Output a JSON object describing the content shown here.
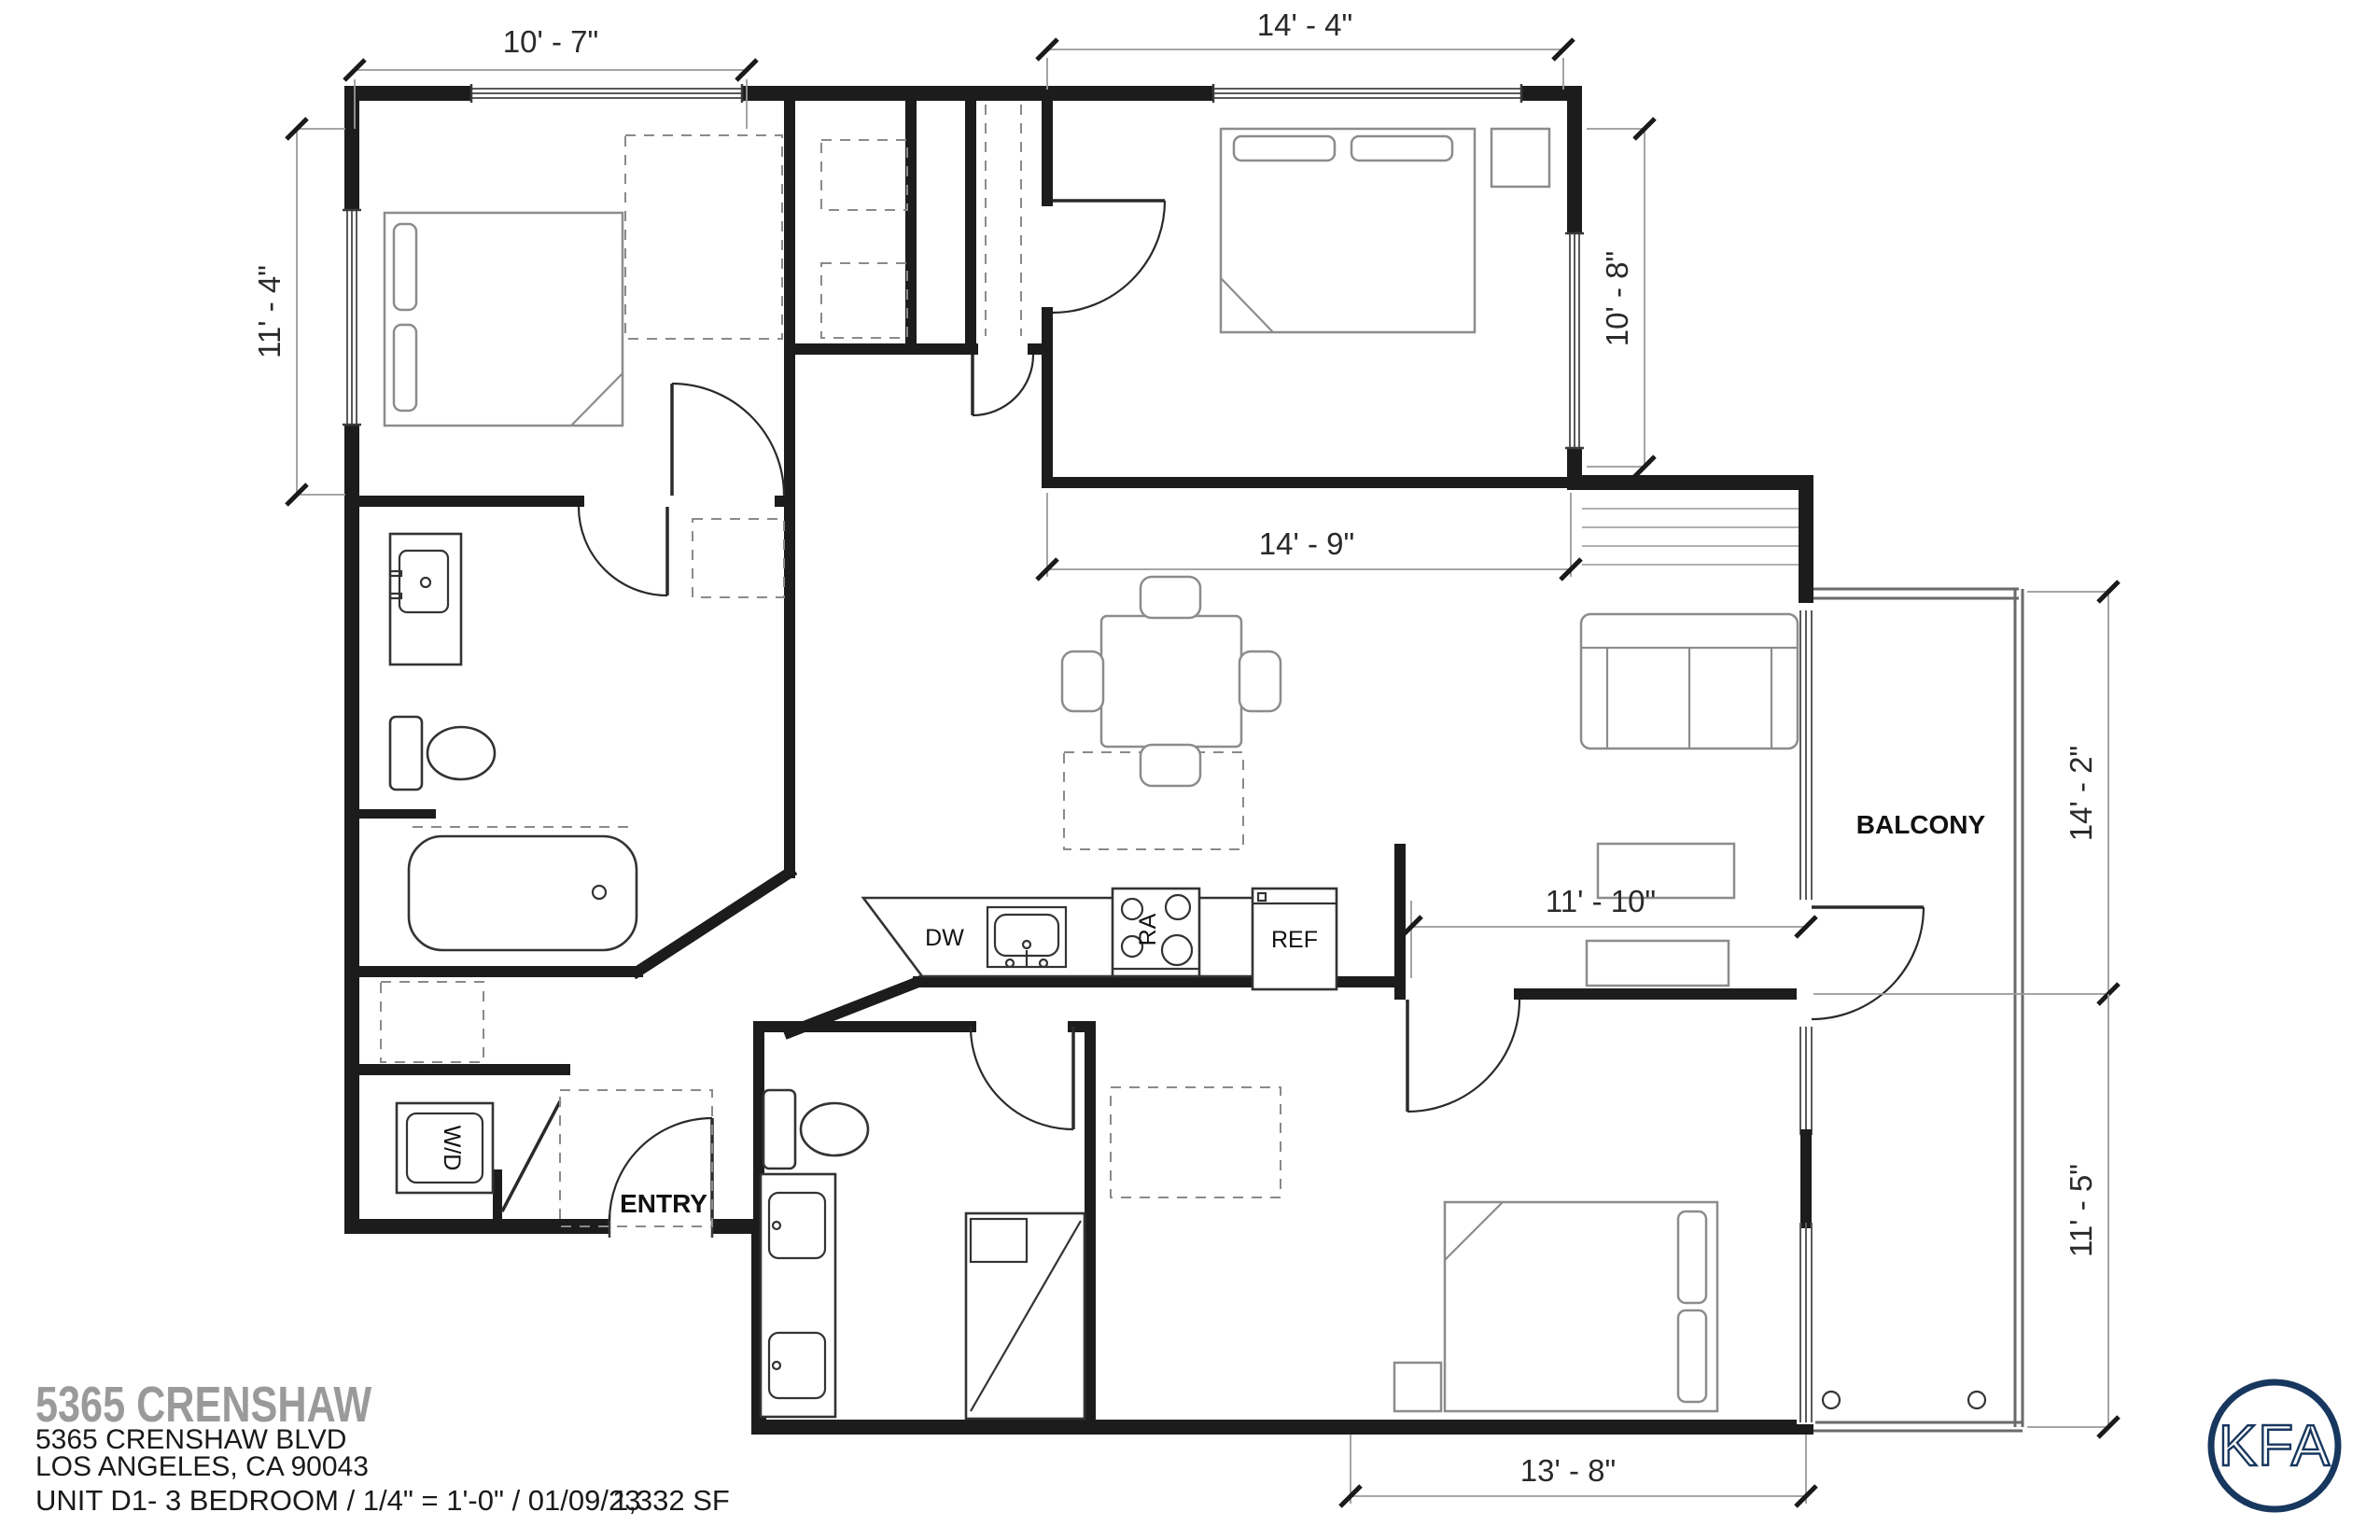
{
  "plan": {
    "dimensions": {
      "top_left": "10' - 7\"",
      "top_right": "14' - 4\"",
      "left_side": "11' - 4\"",
      "bedroom2_right": "10' - 8\"",
      "living_width": "14' - 9\"",
      "balcony_upper": "14' - 2\"",
      "kitchen_width": "11' - 10\"",
      "balcony_lower": "11' - 5\"",
      "bottom": "13' - 8\""
    },
    "room_labels": {
      "balcony": "BALCONY",
      "entry": "ENTRY"
    },
    "appliance_labels": {
      "washer_dryer": "W/D",
      "dishwasher": "DW",
      "range": "RA",
      "refrigerator": "REF"
    }
  },
  "title_block": {
    "project_name": "5365 CRENSHAW",
    "address": "5365 CRENSHAW BLVD\nLOS ANGELES, CA 90043",
    "unit_info": "UNIT D1- 3 BEDROOM /  1/4\" = 1'-0\"  / 01/09/23",
    "area": "1,332 SF"
  },
  "logo": {
    "text": "KFA",
    "color": "#17375e"
  },
  "colors": {
    "wall": "#1c1c1c",
    "furniture": "#8c8c8c",
    "dimension_line": "#9a9a9a",
    "title_gray": "#9a9a9a",
    "logo_navy": "#17375e"
  }
}
